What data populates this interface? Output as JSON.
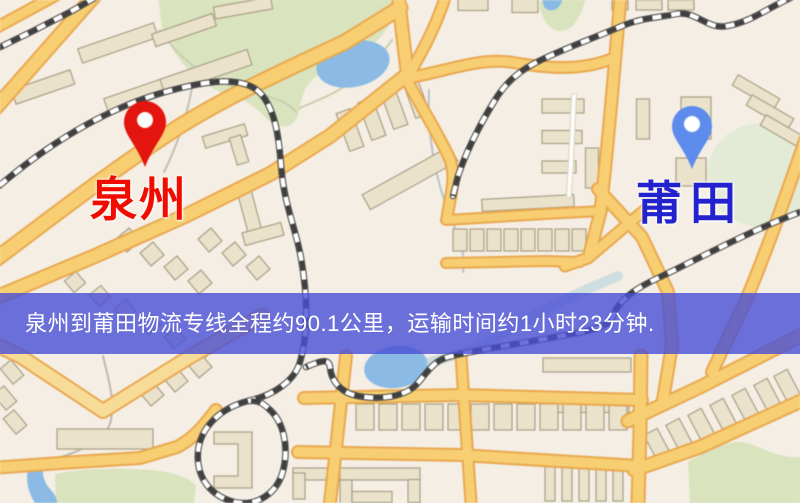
{
  "banner": {
    "text": "泉州到莆田物流专线全程约90.1公里，运输时间约1小时23分钟."
  },
  "markers": {
    "origin": {
      "label": "泉州",
      "pin_color": "#E8140C",
      "label_color": "#F00C00"
    },
    "destination": {
      "label": "莆田",
      "pin_color": "#5C8CF0",
      "label_color": "#2222CF"
    }
  },
  "colors": {
    "map_background": "#F5EEE4",
    "road_fill": "#F8CE6E",
    "road_light_fill": "#F8DC95",
    "road_casing": "#EBA84D",
    "minor_road": "#FDFCF8",
    "minor_road_casing": "#D8D1C5",
    "park": "#D9E3BC",
    "park_soft": "#E3EAD4",
    "water": "#8ABBE6",
    "building_fill": "#EAE2C9",
    "building_stroke": "#A89F85",
    "railway_dark": "#3F3F3F",
    "banner_bg": "rgba(72,79,214,0.80)",
    "banner_text": "#FFFFFF",
    "origin_pin": "#E8140C",
    "origin_label": "#F00C00",
    "dest_pin": "#5C8CF0",
    "dest_label": "#2222CF"
  }
}
